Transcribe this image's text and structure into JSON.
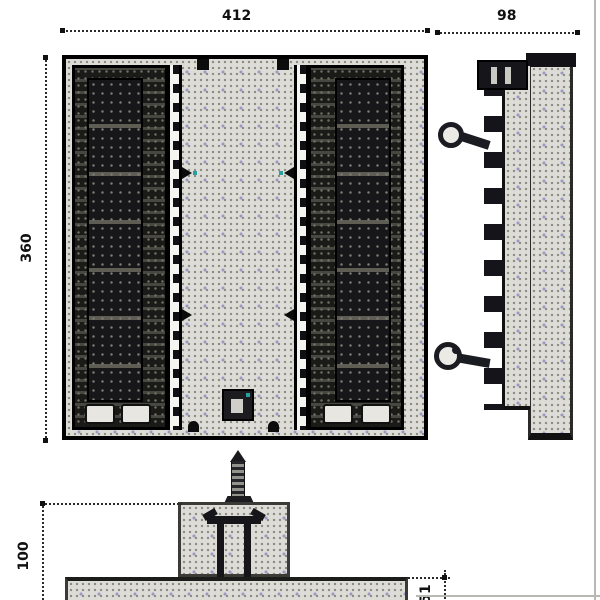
{
  "drawing": {
    "title": "luminaire-three-view-drawing",
    "dims": {
      "top_width": "412",
      "left_height": "360",
      "side_depth": "98",
      "bracket_height": "100",
      "base_thickness": "51"
    },
    "colors": {
      "background": "#ffffff",
      "stipple_base": "#dddcd6",
      "stipple_cross": "#9a9ac8",
      "stipple_dot": "#8b8b84",
      "dark_fill": "#17171a",
      "edge_line": "#000000",
      "dimension_line": "#2a2a2a",
      "teal_fleck": "#29a0a0",
      "frame_gray": "#b8b8b4"
    }
  }
}
